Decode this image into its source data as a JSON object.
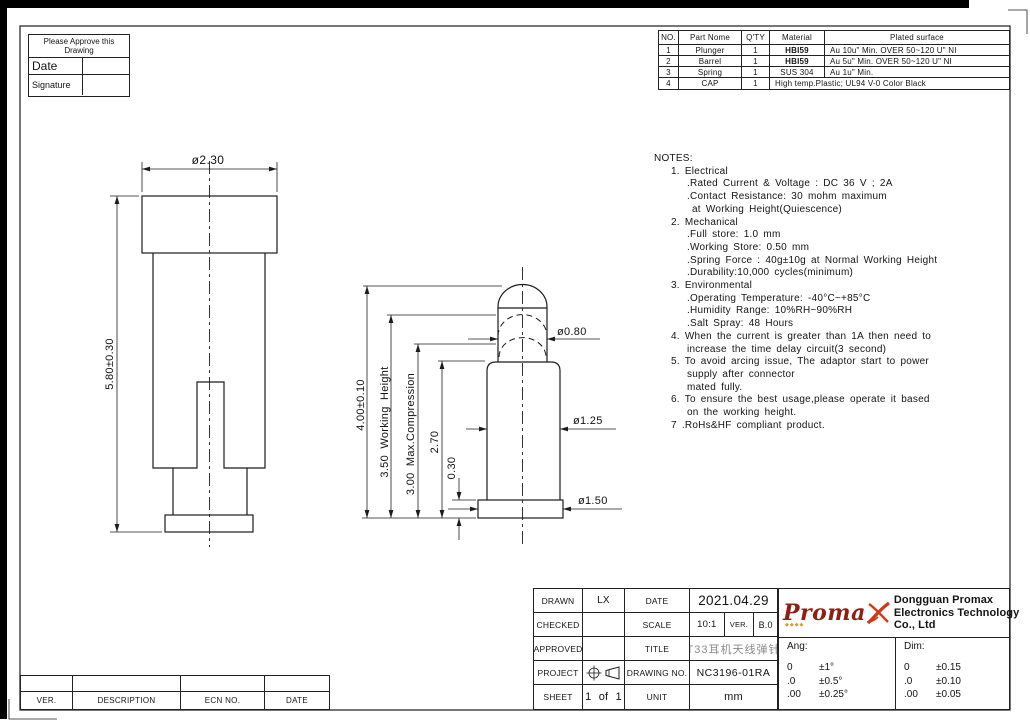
{
  "approve_box": {
    "header": "Please Approve this Drawing",
    "date_label": "Date",
    "signature_label": "Signature"
  },
  "parts_table": {
    "headers": {
      "no": "NO.",
      "name": "Part Nome",
      "qty": "Q'TY",
      "material": "Material",
      "plated": "Plated surface"
    },
    "rows": [
      {
        "no": "1",
        "name": "Plunger",
        "qty": "1",
        "material": "HBI59",
        "plated": "Au 10u\" Min. OVER 50~120 U\" NI"
      },
      {
        "no": "2",
        "name": "Barrel",
        "qty": "1",
        "material": "HBI59",
        "plated": "Au 5u\" Min. OVER 50~120 U\" NI"
      },
      {
        "no": "3",
        "name": "Spring",
        "qty": "1",
        "material": "SUS 304",
        "plated": "Au 1u\" Min."
      },
      {
        "no": "4",
        "name": "CAP",
        "qty": "1",
        "material_plated": "High temp.Plastic; UL94 V-0 Color Black"
      }
    ]
  },
  "notes": {
    "title": "NOTES:",
    "lines": [
      {
        "t": "1. Electrical"
      },
      {
        "t": ".Rated Current & Voltage : DC 36 V ; 2A"
      },
      {
        "t": ".Contact Resistance: 30 mohm maximum"
      },
      {
        "t": "at Working Height(Quiescence)"
      },
      {
        "t": "2. Mechanical"
      },
      {
        "t": ".Full store: 1.0 mm"
      },
      {
        "t": ".Working Store: 0.50 mm"
      },
      {
        "t": ".Spring Force : 40g±10g at Normal Working Height"
      },
      {
        "t": ".Durability:10,000 cycles(minimum)"
      },
      {
        "t": "3. Environmental"
      },
      {
        "t": ".Operating Temperature: -40°C~+85°C"
      },
      {
        "t": ".Humidity Range: 10%RH~90%RH"
      },
      {
        "t": ".Salt Spray: 48 Hours"
      },
      {
        "t": "4. When the current is greater than 1A then need to"
      },
      {
        "t": "increase the time delay circuit(3 second)"
      },
      {
        "t": "5. To avoid arcing issue, The adaptor start to power"
      },
      {
        "t": "supply after connector"
      },
      {
        "t": "mated fully."
      },
      {
        "t": "6. To ensure the best usage,please operate it based"
      },
      {
        "t": "on the working height."
      },
      {
        "t": "7 .RoHs&HF compliant product."
      }
    ]
  },
  "dims": {
    "left_width": "ø2.30",
    "left_height": "5.80±0.30",
    "mid_total": "4.00±0.10",
    "mid_working": "3.50 Working Height",
    "mid_compression": "3.00 Max.Compression",
    "mid_270": "2.70",
    "mid_030": "0.30",
    "dia_tip": "ø0.80",
    "dia_barrel": "ø1.25",
    "dia_flange": "ø1.50"
  },
  "title_block": {
    "rows": [
      {
        "label": "DRAWN",
        "value": "LX",
        "label2": "DATE",
        "value2": "2021.04.29"
      },
      {
        "label": "CHECKED",
        "value": "",
        "label2": "SCALE",
        "value2": "10:1",
        "ver_label": "VER.",
        "ver_value": "B.0"
      },
      {
        "label": "APPROVED",
        "value": "",
        "label2": "TITLE",
        "value2": "T33耳机天线弹针"
      },
      {
        "label": "PROJECT",
        "value": "",
        "label2": "DRAWING NO.",
        "value2": "NC3196-01RA"
      },
      {
        "label": "SHEET",
        "value": "1 of 1",
        "label2": "UNIT",
        "value2": "mm"
      }
    ]
  },
  "company": {
    "logo_text": "Proma",
    "name_lines": [
      "Dongguan Promax",
      "Electronics Technology",
      "Co., Ltd"
    ]
  },
  "tolerances": {
    "ang_label": "Ang:",
    "ang_rows": [
      {
        "v": "0",
        "t": "±1°"
      },
      {
        "v": ".0",
        "t": "±0.5°"
      },
      {
        "v": ".00",
        "t": "±0.25°"
      }
    ],
    "dim_label": "Dim:",
    "dim_rows": [
      {
        "v": "0",
        "t": "±0.15"
      },
      {
        "v": ".0",
        "t": "±0.10"
      },
      {
        "v": ".00",
        "t": "±0.05"
      }
    ]
  },
  "revision_table": {
    "ver": "VER.",
    "description": "DESCRIPTION",
    "ecn": "ECN NO.",
    "date": "DATE"
  }
}
